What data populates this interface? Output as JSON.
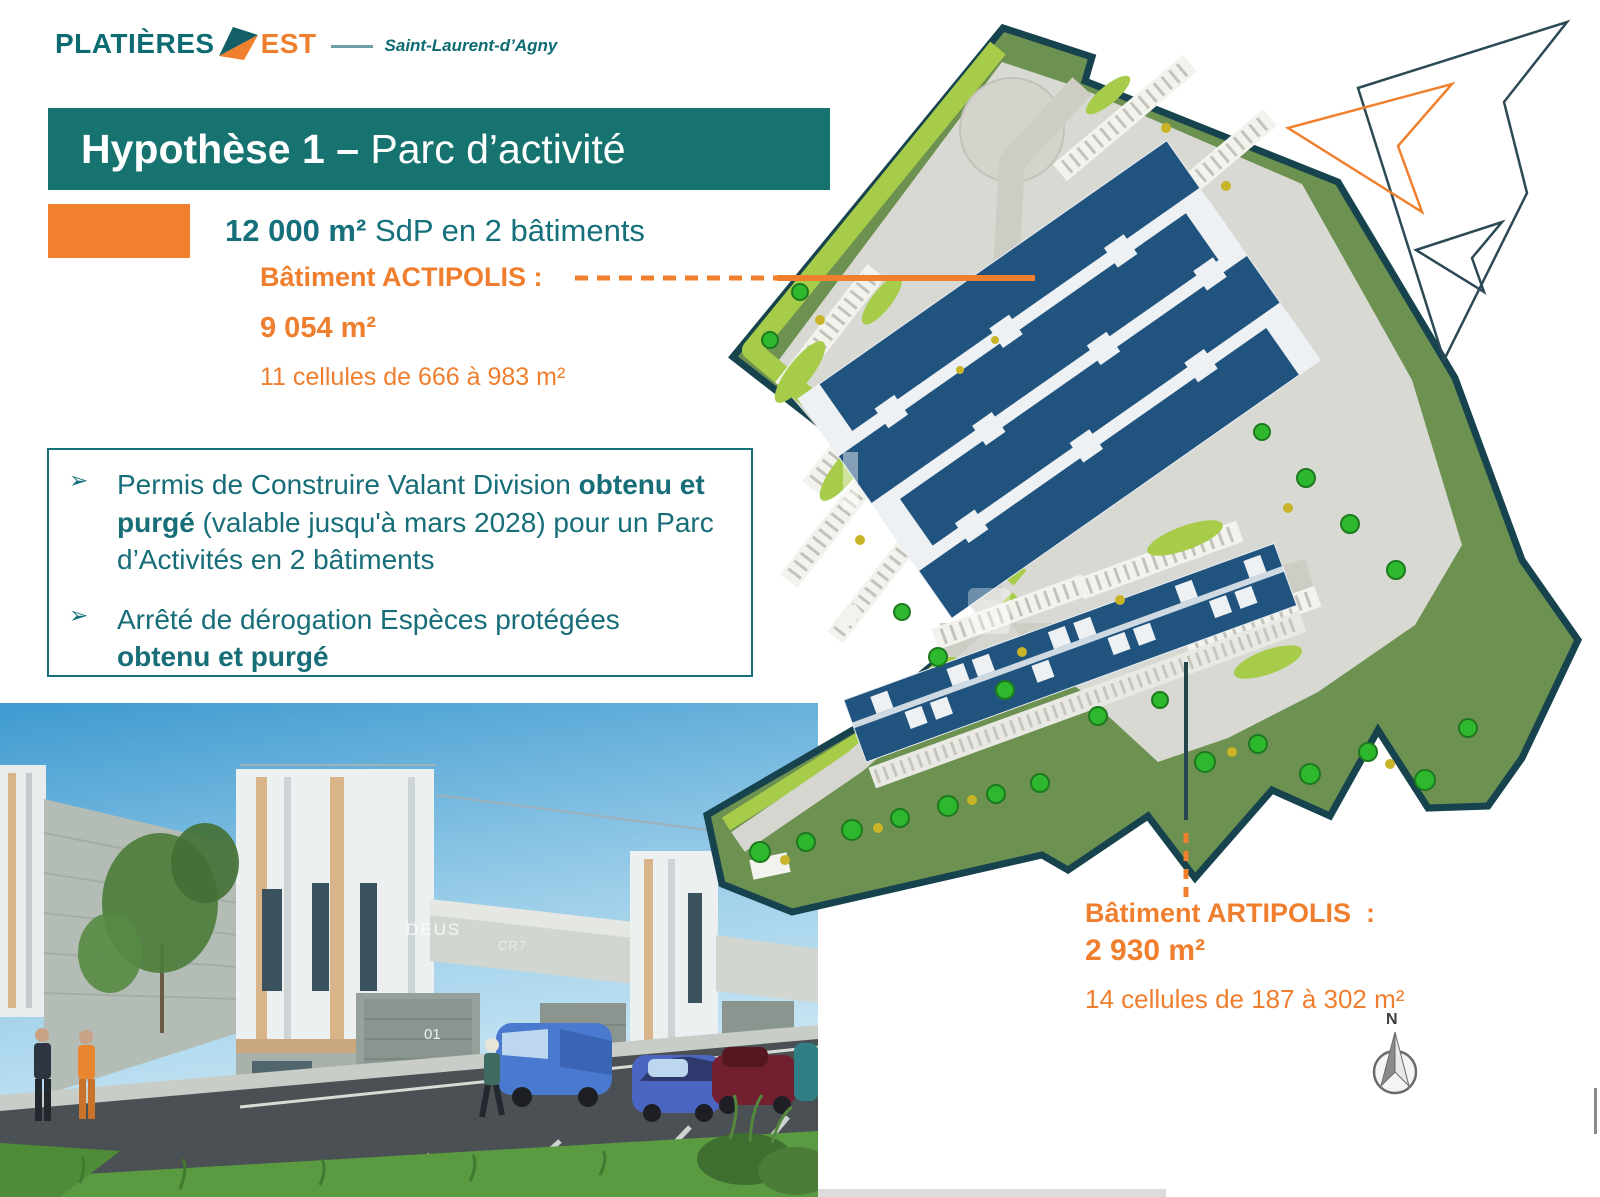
{
  "brand": {
    "name_primary": "PLATIÈRES",
    "name_secondary": "EST",
    "location": "Saint-Laurent-d’Agny"
  },
  "header": {
    "title_bold": "Hypothèse 1 – ",
    "title_regular": "Parc d’activité"
  },
  "summary": {
    "area_bold": "12 000 m²",
    "area_regular": " SdP en 2 bâtiments"
  },
  "actipolis": {
    "label": "Bâtiment ACTIPOLIS :",
    "area": "9 054 m²",
    "cells": "11 cellules de 666 à 983 m²"
  },
  "artipolis": {
    "label": "Bâtiment ARTIPOLIS  :",
    "area": "2 930 m²",
    "cells": "14 cellules de 187 à 302 m²"
  },
  "permits": {
    "bullet_glyph": "➢",
    "item1": {
      "normal_1": "Permis de Construire Valant Division ",
      "bold_1": "obtenu et purgé",
      "normal_2": " (valable jusqu'à mars 2028) pour un Parc d’Activités en 2 bâtiments"
    },
    "item2": {
      "normal_1": "Arrêté de dérogation Espèces protégées ",
      "bold_1": "obtenu et purgé"
    }
  },
  "site_plan": {
    "compass_label": "N"
  },
  "photo": {
    "unit_label_1": "DEUS",
    "unit_label_2": "CR7",
    "door_label": "01"
  },
  "colors": {
    "teal_banner": "#17736f",
    "teal_text": "#15707b",
    "orange": "#f0802e",
    "plan_outline": "#17434f",
    "roof_blue": "#20537e",
    "grass_green": "#a6cc49"
  }
}
